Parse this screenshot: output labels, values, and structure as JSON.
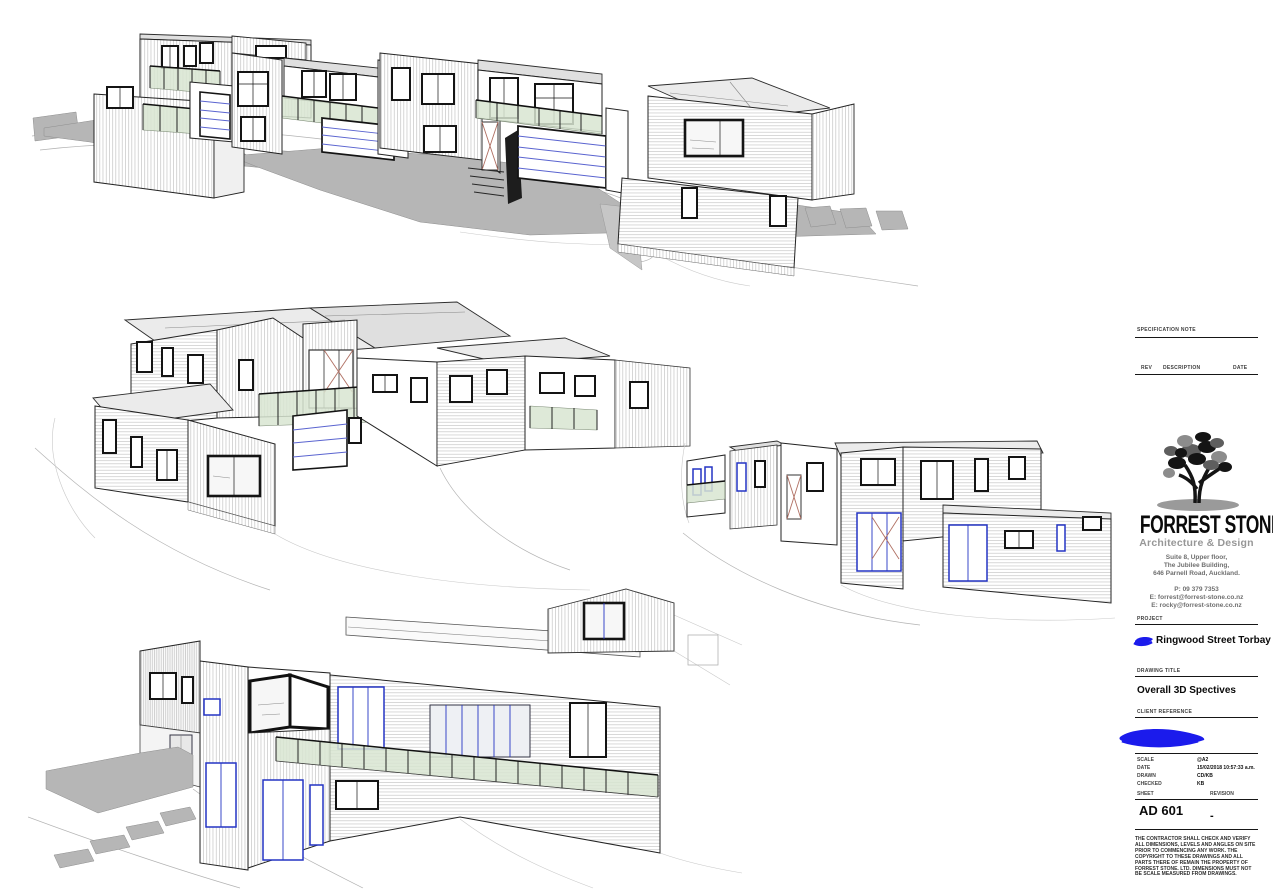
{
  "sheet": {
    "background": "#ffffff",
    "views": [
      {
        "id": "top",
        "description": "3D street-front perspective of townhouse row with garage doors, balconies and grey driveways, detached two-storey house at right"
      },
      {
        "id": "middle-left",
        "description": "3D rear perspective of townhouse row with low-pitch roofs, long balcony and single-storey wing"
      },
      {
        "id": "middle-right",
        "description": "3D rear-corner perspective of end unit with flat roof and single-storey wing, row receding to the left"
      },
      {
        "id": "bottom",
        "description": "3D close-up perspective of entry facade with corner window, glazed balcony, blue joinery, grey patio and stepping stones"
      }
    ],
    "colors": {
      "joinery_blue": "#2434c4",
      "garage_line_blue": "#5a64d0",
      "balcony_glass_green": "#d9e6d2",
      "driveway_gray": "#b6b6b6",
      "roof_gray": "#ebebeb",
      "scribble_blue": "#1b1bec",
      "line_dark": "#161616"
    },
    "title_block": {
      "specification_note_label": "SPECIFICATION NOTE",
      "revision_table": {
        "rev_label": "REV",
        "description_label": "DESCRIPTION",
        "date_label": "DATE"
      },
      "firm": {
        "name": "FORREST STONE",
        "tagline": "Architecture & Design",
        "address_lines": [
          "Suite 8, Upper floor,",
          "The Jubilee Building,",
          "646 Parnell Road, Auckland."
        ],
        "phone": "P: 09 379 7353",
        "email1": "E: forrest@forrest-stone.co.nz",
        "email2": "E: rocky@forrest-stone.co.nz"
      },
      "project": {
        "label": "PROJECT",
        "name": "Ringwood Street Torbay"
      },
      "drawing_title": {
        "label": "DRAWING TITLE",
        "value": "Overall 3D Spectives"
      },
      "client_reference": {
        "label": "CLIENT REFERENCE"
      },
      "meta": {
        "scale_label": "SCALE",
        "scale_value": "@A2",
        "date_label": "DATE",
        "date_value": "15/02/2018 10:57:33 a.m.",
        "drawn_label": "DRAWN",
        "drawn_value": "CD/KB",
        "checked_label": "CHECKED",
        "checked_value": "KB",
        "sheet_label": "SHEET",
        "sheet_value": "AD 601",
        "revision_label": "REVISION",
        "revision_value": "-"
      },
      "disclaimer": "THE CONTRACTOR SHALL CHECK AND VERIFY ALL DIMENSIONS, LEVELS AND ANGLES ON SITE PRIOR TO COMMENCING ANY WORK. THE COPYRIGHT TO THESE DRAWINGS AND ALL PARTS THERE OF REMAIN THE PROPERTY OF FORREST STONE. LTD. DIMENSIONS MUST NOT BE SCALE MEASURED FROM DRAWINGS."
    }
  }
}
